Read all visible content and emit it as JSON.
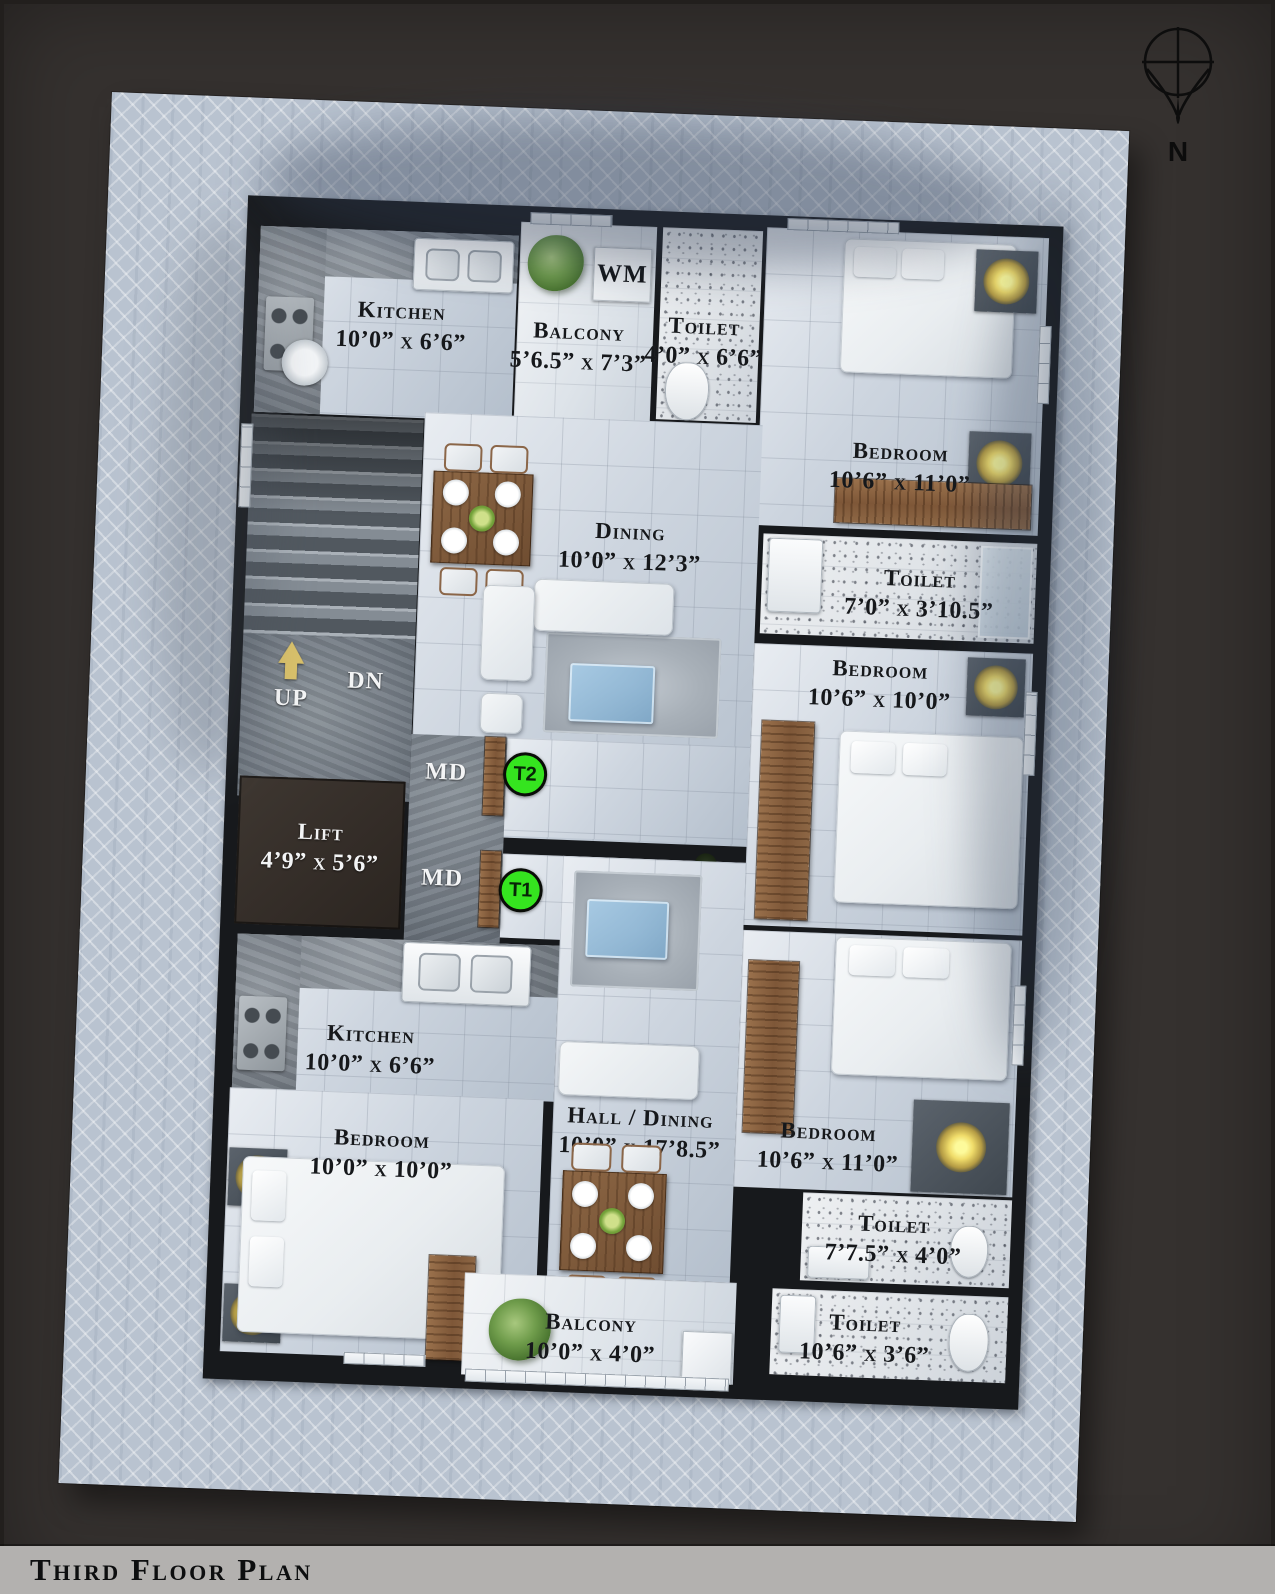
{
  "title": "Third Floor Plan",
  "compass": {
    "north": "N"
  },
  "labels": {
    "wm": "WM",
    "up": "UP",
    "dn": "DN",
    "md": "MD",
    "t1": "T1",
    "t2": "T2"
  },
  "rooms": {
    "kitchen_top": {
      "name": "Kitchen",
      "dims": "10’0” x 6’6”"
    },
    "balcony_top": {
      "name": "Balcony",
      "dims": "5’6.5” x 7’3”"
    },
    "toilet_top": {
      "name": "Toilet",
      "dims": "4’0” x 6’6”"
    },
    "bedroom_top_right": {
      "name": "Bedroom",
      "dims": "10’6” x 11’0”"
    },
    "dining": {
      "name": "Dining",
      "dims": "10’0” x 12’3”"
    },
    "toilet_mid": {
      "name": "Toilet",
      "dims": "7’0” x 3’10.5”"
    },
    "bedroom_mid_right": {
      "name": "Bedroom",
      "dims": "10’6” x 10’0”"
    },
    "lift": {
      "name": "Lift",
      "dims": "4’9” x 5’6”"
    },
    "kitchen_bottom": {
      "name": "Kitchen",
      "dims": "10’0” x 6’6”"
    },
    "bedroom_bottom_left": {
      "name": "Bedroom",
      "dims": "10’0” x 10’0”"
    },
    "hall_dining": {
      "name": "Hall / Dining",
      "dims": "10’0” x 17’8.5”"
    },
    "bedroom_bottom_right": {
      "name": "Bedroom",
      "dims": "10’6” x 11’0”"
    },
    "toilet_bottom_1": {
      "name": "Toilet",
      "dims": "7’7.5” x 4’0”"
    },
    "toilet_bottom_2": {
      "name": "Toilet",
      "dims": "10’6” x 3’6”"
    },
    "balcony_bottom": {
      "name": "Balcony",
      "dims": "10’0” x 4’0”"
    }
  },
  "colors": {
    "tag_green": "#35e41f",
    "wall": "#17191c",
    "paving": "#b9c3d0",
    "footer": "#b3b1af"
  }
}
